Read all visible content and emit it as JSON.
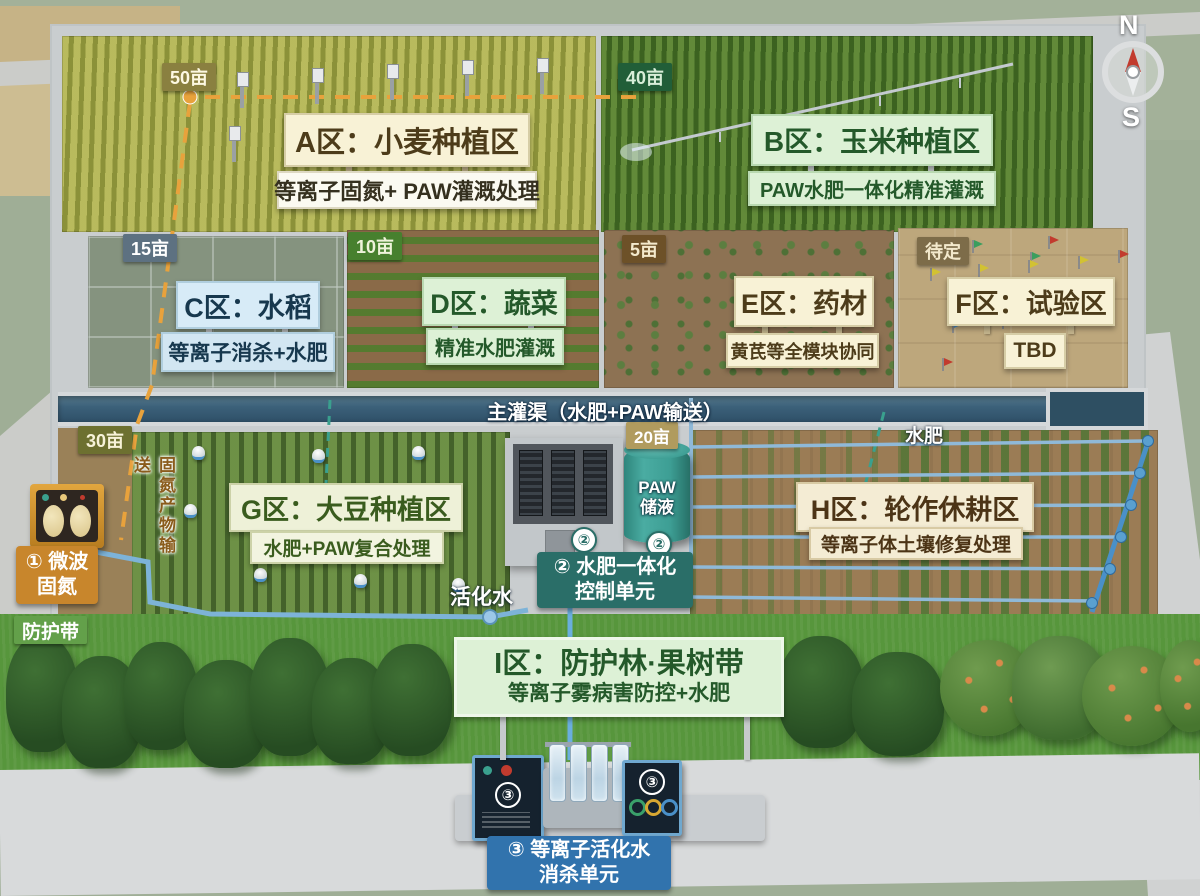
{
  "compass": {
    "north": "N",
    "south": "S"
  },
  "canal": {
    "label": "主灌渠（水肥+PAW输送）"
  },
  "zones": [
    {
      "id": "A",
      "badge": "50亩",
      "title": "A区：小麦种植区",
      "subtitle": "等离子固氮+ PAW灌溉处理"
    },
    {
      "id": "B",
      "badge": "40亩",
      "title": "B区：玉米种植区",
      "subtitle": "PAW水肥一体化精准灌溉"
    },
    {
      "id": "C",
      "badge": "15亩",
      "title": "C区：水稻",
      "subtitle": "等离子消杀+水肥"
    },
    {
      "id": "D",
      "badge": "10亩",
      "title": "D区：蔬菜",
      "subtitle": "精准水肥灌溉"
    },
    {
      "id": "E",
      "badge": "5亩",
      "title": "E区：药材",
      "subtitle": "黄芪等全模块协同"
    },
    {
      "id": "F",
      "badge": "待定",
      "title": "F区：试验区",
      "subtitle": "TBD"
    },
    {
      "id": "G",
      "badge": "30亩",
      "title": "G区：大豆种植区",
      "subtitle": "水肥+PAW复合处理"
    },
    {
      "id": "H",
      "badge": "20亩",
      "title": "H区：轮作休耕区",
      "subtitle": "等离子体土壤修复处理"
    },
    {
      "id": "I",
      "title": "I区：防护林·果树带",
      "subtitle": "等离子雾病害防控+水肥"
    }
  ],
  "facilities": {
    "microwave_nitrogen": {
      "line1": "① 微波",
      "line2": "固氮"
    },
    "fertigation_control": {
      "badge_num": "②",
      "line1": "② 水肥一体化",
      "line2": "控制单元"
    },
    "paw_tank": {
      "badge_num": "②",
      "line1": "PAW",
      "line2": "储液"
    },
    "plasma_water_unit": {
      "badge_num": "③",
      "line1": "③ 等离子活化水",
      "line2": "消杀单元"
    }
  },
  "flow_labels": {
    "nitrogen_transport": "固氮产物输送",
    "fertilizer_water": "水肥",
    "activated_water": "活化水",
    "shelter_belt": "防护带"
  },
  "colors": {
    "nitrogen_dashed_line": "#e8a23c",
    "control_teal": "#2a6e68",
    "unit_blue": "#3173ad",
    "canal_water": "#3d617a",
    "paw_tank_teal": "#3d9e94",
    "microwave_orange": "#c8862c"
  }
}
